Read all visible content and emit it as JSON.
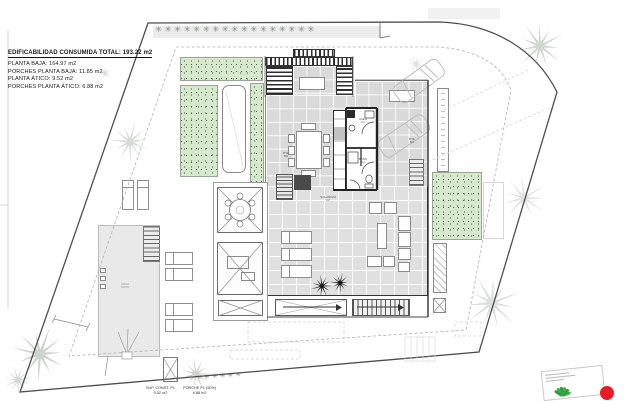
{
  "legend": {
    "title": "EDIFICABILIDAD CONSUMIDA TOTAL: 193.22 m2",
    "lines": [
      "PLANTA BAJA: 164.97 m2",
      "PORCHES PLANTA BAJA: 11.85 m2",
      "PLANTA ÁTICO: 9.52 m2",
      "PORCHES PLANTA ÁTICO: 6.88 m2"
    ]
  },
  "summary": {
    "cols": [
      {
        "label": "SUP. CONST. P1",
        "value": "9.52 m2"
      },
      {
        "label": "PORCHE P1 (50%)",
        "value": "6.88 m2"
      }
    ]
  },
  "labels": {
    "solarium": "SOLARIUM",
    "solarium_unit": "m²",
    "upper_bath": "ASEO",
    "lower_bath": "BAÑO",
    "unit": "m²",
    "slope_1": "PTE",
    "slope_2": "6%"
  },
  "decor": {
    "hedge_top": "✳✳✳✳✳✳✳✳✳✳✳✳✳✳✳✳✳",
    "hedge_bottom": "✳✳✳✳✳✳"
  },
  "colors": {
    "lawn_green": "#d7e9cd",
    "speckle_green": "#46663e",
    "paving_gray": "#dadada",
    "boundary": "#4d4d4d",
    "red_marker": "#e81c24",
    "logo_green": "#3fae49"
  }
}
